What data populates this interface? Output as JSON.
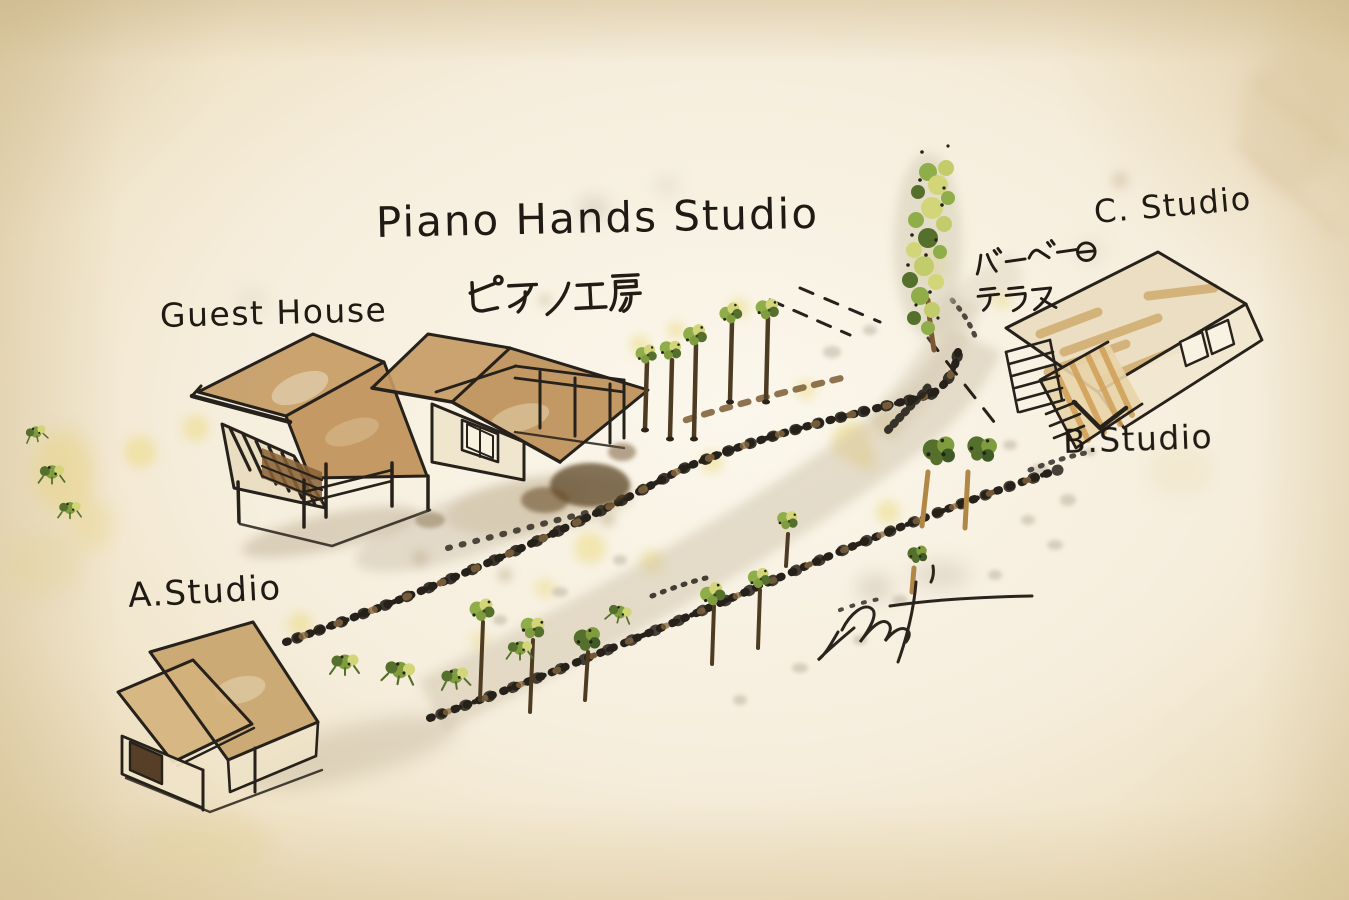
{
  "artwork": {
    "kind": "hand-drawn watercolor site map",
    "site_name": "Piano Hands Studio"
  },
  "labels": {
    "title": "Piano Hands Studio",
    "guest_house": "Guest House",
    "piano_workshop_ja": "ピアノ工房",
    "a_studio": "A.Studio",
    "b_studio": "B.Studio",
    "c_studio": "C. Studio",
    "bbq_terrace_line1": "バーベーQ",
    "bbq_terrace_line2": "テラス"
  },
  "colors": {
    "paper": "#f3ebd9",
    "ink": "#26211a",
    "roof_brown": "#c49a63",
    "deck_tan": "#cf9f55",
    "foliage_green": "#7f9c3e",
    "foliage_yellow_green": "#d3d678",
    "foliage_dark_green": "#55702c",
    "stain_yellow": "#ecd97e",
    "gravel_gray": "#cdc2ac"
  }
}
